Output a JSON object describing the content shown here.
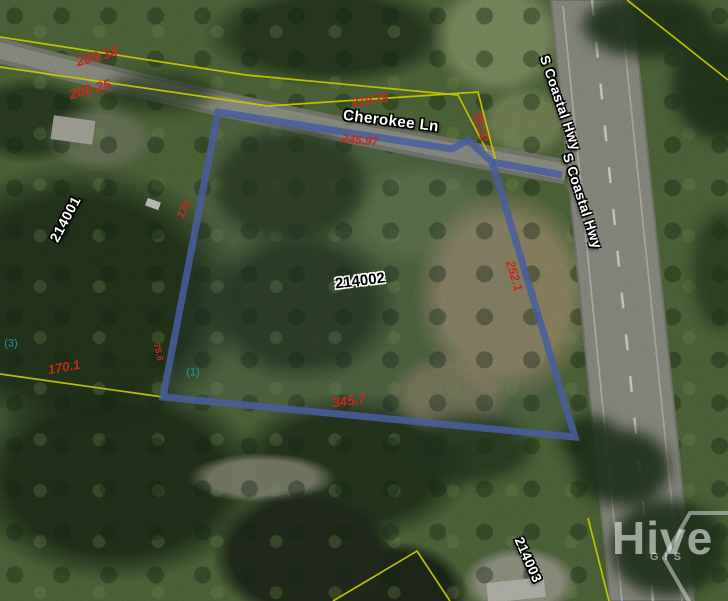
{
  "streets": {
    "cherokee_ln": "Cherokee Ln",
    "s_coastal_hwy_north": "S Coastal Hwy",
    "s_coastal_hwy_south": "S Coastal Hwy"
  },
  "parcels": {
    "west": "214001",
    "selected": "214002",
    "south": "214003"
  },
  "lot_counts": {
    "west": "(3)",
    "selected": "(1)"
  },
  "dimensions": {
    "road_north": "200.34",
    "road_south": "200.25",
    "cherokee_north": "219.79",
    "parcel_top": "245.97",
    "sliver_width": "32.12",
    "parcel_right": "252.1",
    "west_parcel_east": "170",
    "parcel_left": "75.6",
    "southwest_edge": "170.1",
    "parcel_bottom": "345.7"
  },
  "watermark": {
    "brand": "Hive",
    "sub": "GIS"
  },
  "colors": {
    "selected_parcel_outline": "#5570be",
    "parcel_line": "#ecec00",
    "dimension_text": "#c62a1c",
    "lot_count_text": "#17a093",
    "road_surface": "#9a9b90"
  }
}
